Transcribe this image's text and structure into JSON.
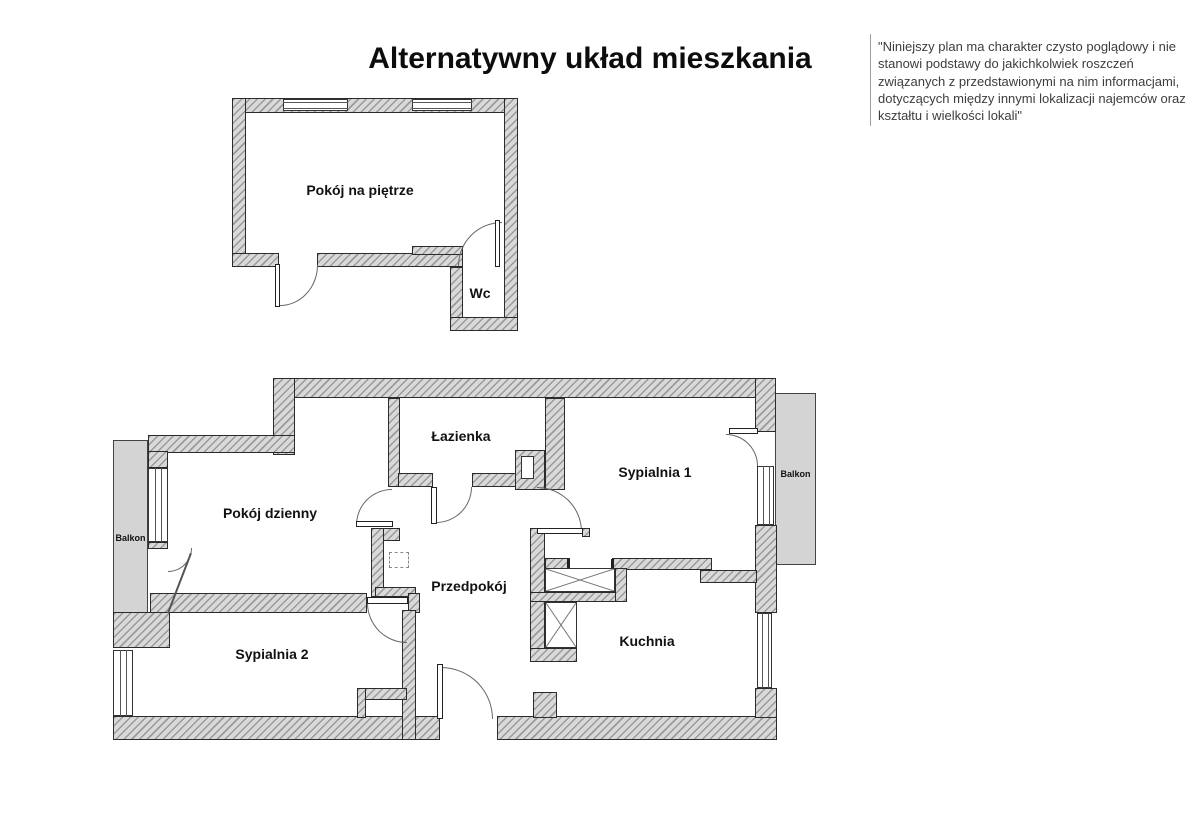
{
  "title": "Alternatywny układ mieszkania",
  "disclaimer": "\"Niniejszy plan ma charakter czysto poglądowy i nie stanowi podstawy do jakichkolwiek roszczeń związanych z przedstawionymi na nim informacjami, dotyczących między innymi lokalizacji najemców oraz kształtu i wielkości lokali\"",
  "upper_floor": {
    "rooms": [
      {
        "label": "Pokój na piętrze"
      },
      {
        "label": "Wc"
      }
    ]
  },
  "main_floor": {
    "rooms": [
      {
        "label": "Pokój dzienny"
      },
      {
        "label": "Łazienka"
      },
      {
        "label": "Sypialnia 1"
      },
      {
        "label": "Sypialnia 2"
      },
      {
        "label": "Przedpokój"
      },
      {
        "label": "Kuchnia"
      }
    ],
    "balconies": [
      {
        "label": "Balkon"
      },
      {
        "label": "Balkon"
      }
    ]
  },
  "colors": {
    "wall_hatch_line": "#9a9a9a",
    "wall_hatch_bg": "#d9d9d9",
    "wall_outline": "#2b2b2b",
    "balcony_fill": "#d4d4d4",
    "label_text": "#111111",
    "disclaimer_text": "#3d3d3d"
  }
}
